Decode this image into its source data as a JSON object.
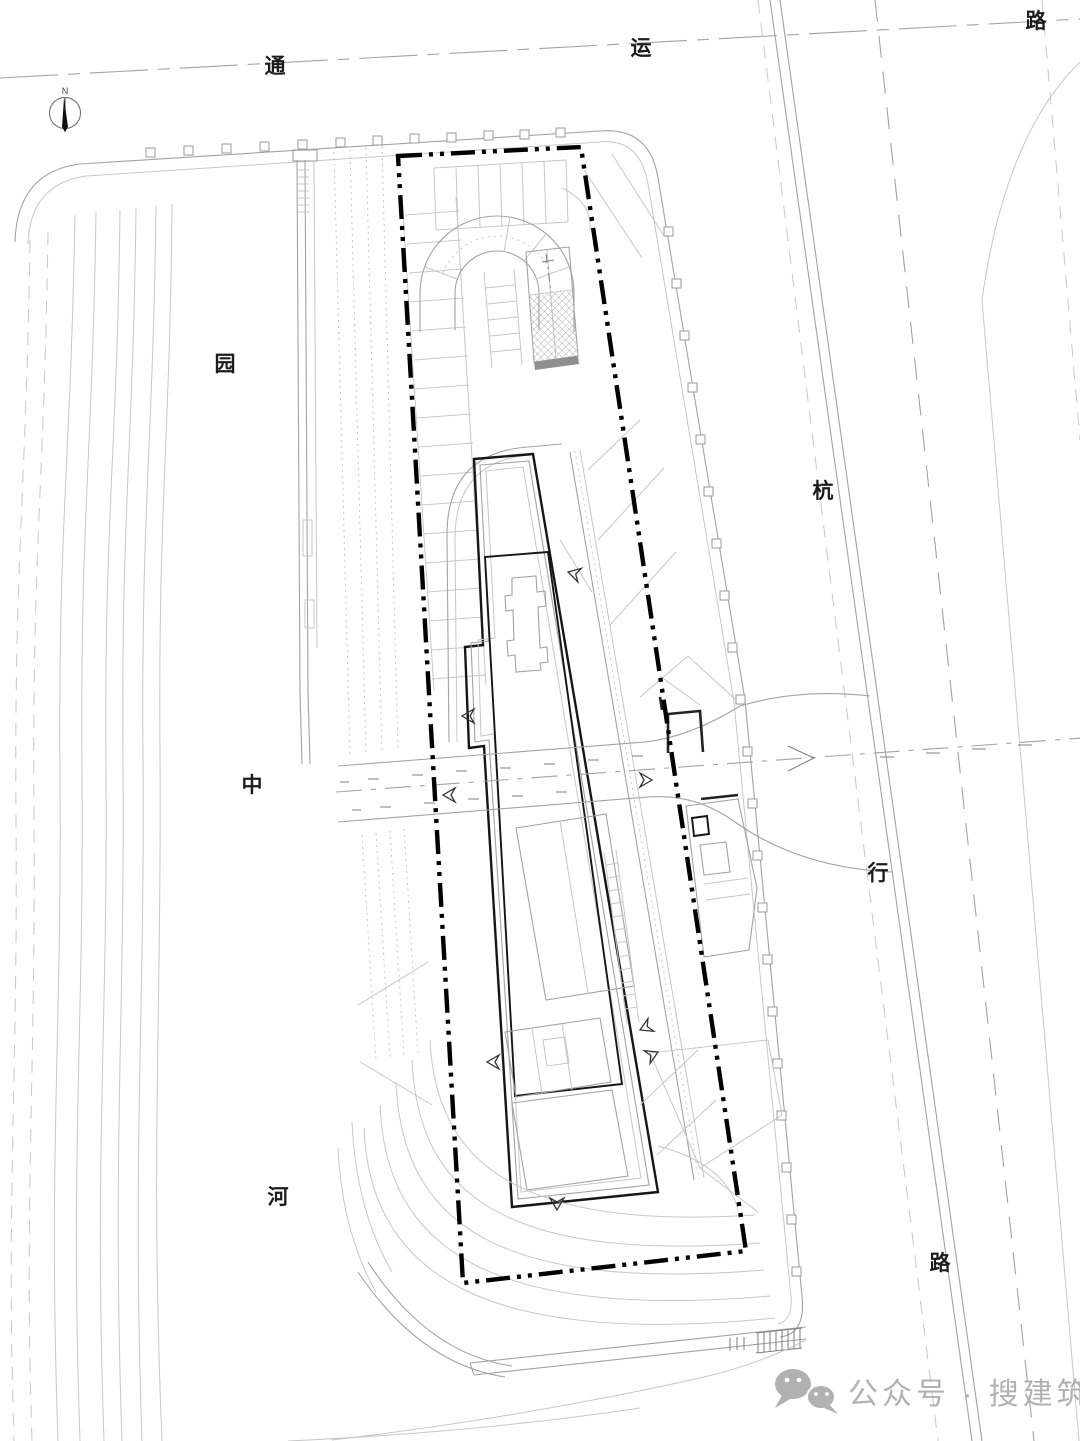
{
  "page": {
    "type": "architectural-site-plan",
    "background": "#ffffff"
  },
  "labels": {
    "road_top": [
      "通",
      "运",
      "路"
    ],
    "road_right": [
      "杭",
      "行",
      "路"
    ],
    "river": [
      "园",
      "中",
      "河"
    ]
  },
  "north_arrow": {
    "label": "N"
  },
  "watermark": {
    "text": "公众号 · 搜建筑",
    "icon": "wechat-icon",
    "color": "#a9a9a9"
  },
  "colors": {
    "line_light": "#c7c7c7",
    "line_mid": "#a3a3a3",
    "line_bold": "#161616",
    "boundary": "#000000",
    "hatch": "#9a9a9a",
    "watermark": "#a9a9a9"
  }
}
